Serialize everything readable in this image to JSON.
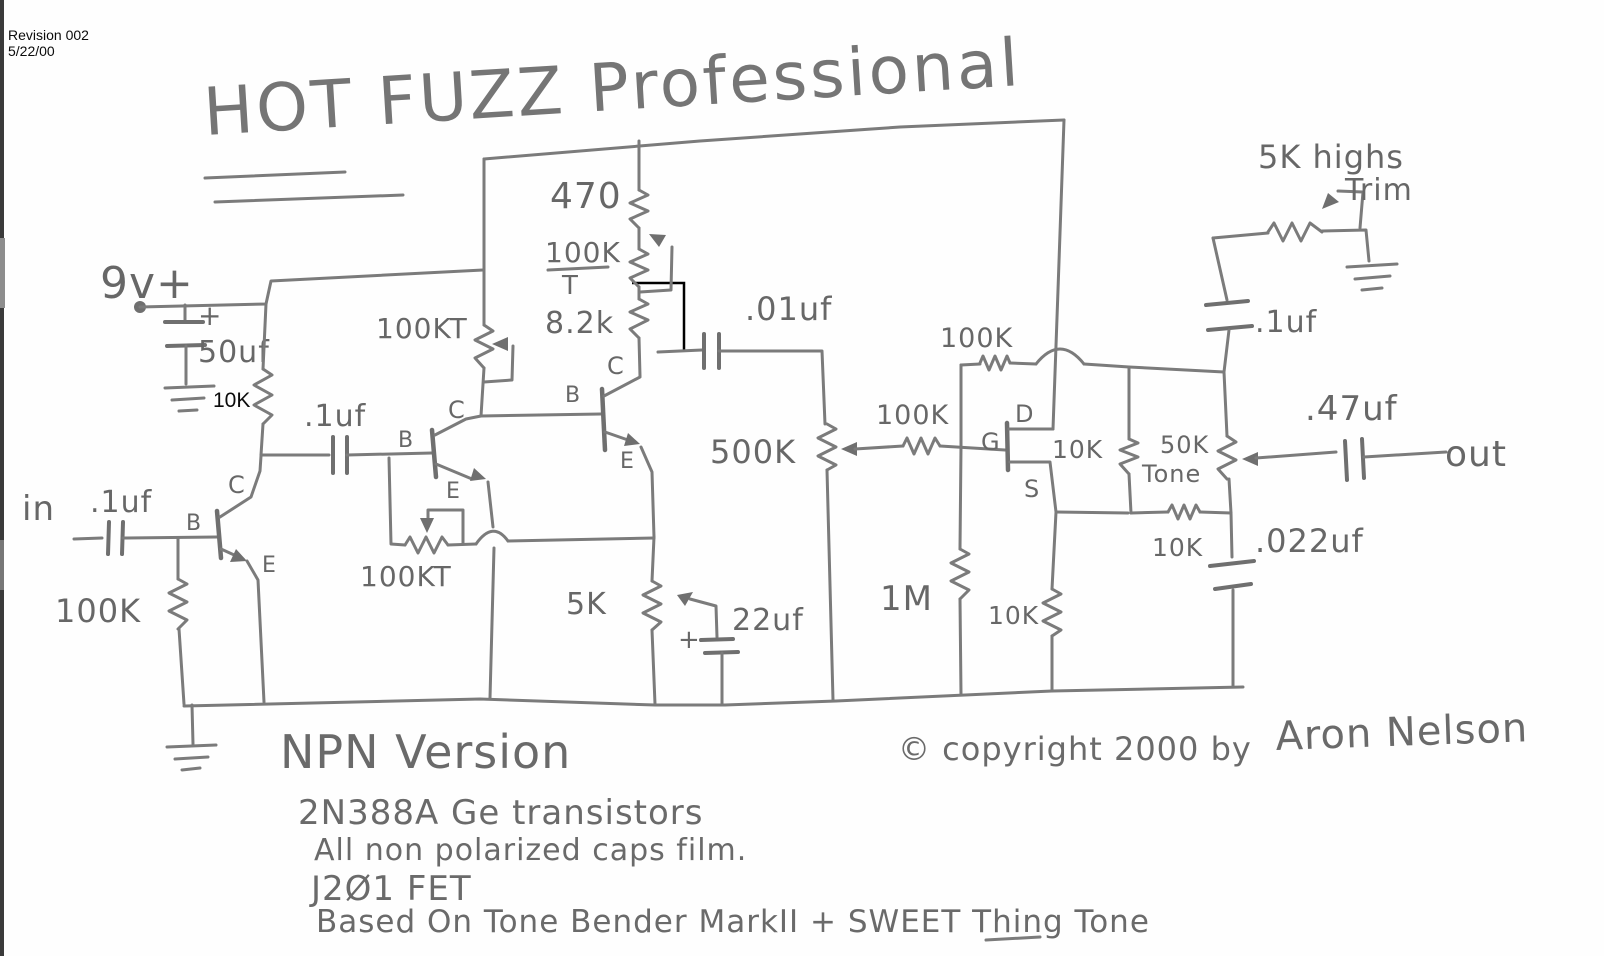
{
  "scan_header": {
    "revision": "Revision 002",
    "date": "5/22/00"
  },
  "title": "HOT FUZZ Professional",
  "schematic": {
    "terminals": {
      "supply": "9v+",
      "input": "in",
      "output": "out"
    },
    "pins": {
      "b": "B",
      "c": "C",
      "e": "E",
      "g": "G",
      "d": "D",
      "s": "S"
    },
    "components": {
      "filter_cap": "50uf",
      "filter_cap_plus": "+",
      "r10k_annotated": "10K",
      "input_cap": ".1uf",
      "input_r": "100K",
      "interstage_cap": ".1uf",
      "trim_upper": "100KT",
      "trim_lower": "100KT",
      "r470": "470",
      "r100k_col": "100K",
      "r100k_col_t": "T",
      "r8k2": "8.2k",
      "c01": ".01uf",
      "r5k": "5K",
      "c22": "22uf",
      "c22_plus": "+",
      "pot500k": "500K",
      "r100k_gate": "100K",
      "r100k_fb": "100K",
      "r1m": "1M",
      "r10k_drain": "10K",
      "r10k_mid": "10K",
      "r10k_source": "10K",
      "pot50k": "50K",
      "pot50k_name": "Tone",
      "c022": ".022uf",
      "c47": ".47uf",
      "c1uf_out": ".1uf",
      "trim_highs": "5K highs",
      "trim_highs_name": "Trim"
    }
  },
  "notes": {
    "l1": "NPN Version",
    "l2": "2N388A Ge transistors",
    "l3": "All non polarized caps film.",
    "l4": "J2Ø1 FET",
    "l5": "Based On Tone Bender MarkII + SWEET Thing Tone"
  },
  "copyright": {
    "line": "© copyright 2000 by",
    "author": "Aron Nelson"
  }
}
